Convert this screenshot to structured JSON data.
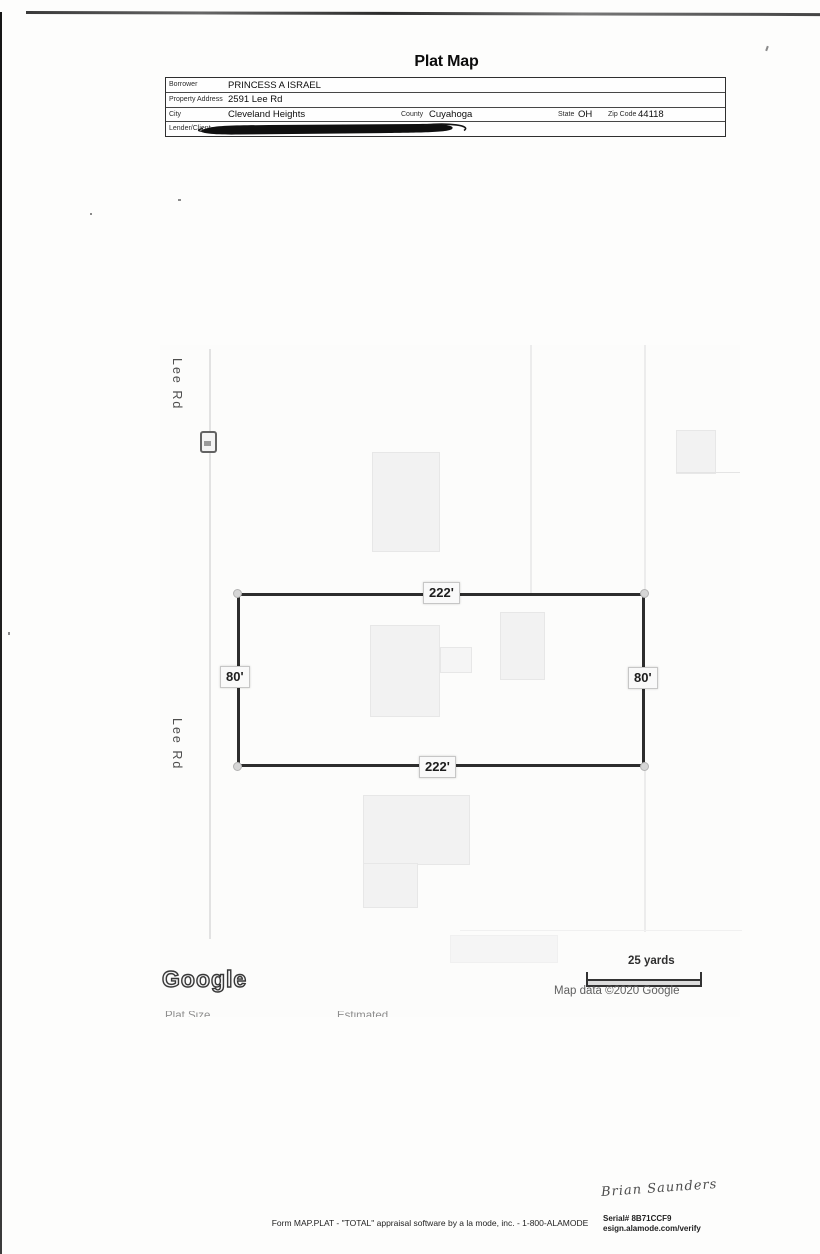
{
  "page": {
    "title": "Plat Map"
  },
  "form": {
    "rows": [
      {
        "label": "Borrower",
        "value": "PRINCESS A ISRAEL"
      },
      {
        "label": "Property Address",
        "value": "2591 Lee Rd"
      },
      {
        "label": "City",
        "value": "Cleveland Heights",
        "county_label": "County",
        "county_value": "Cuyahoga",
        "state_label": "State",
        "state_value": "OH",
        "zip_label": "Zip Code",
        "zip_value": "44118"
      },
      {
        "label": "Lender/Client",
        "value": ""
      }
    ]
  },
  "map": {
    "road_label": "Lee Rd",
    "plat_dimensions": {
      "top": "222'",
      "bottom": "222'",
      "left": "80'",
      "right": "80'"
    },
    "scale_label": "25 yards",
    "attribution": "Map data ©2020 Google",
    "logo_text": "Google",
    "clipped_caption": {
      "left": "Plat Size",
      "right": "Estimated"
    }
  },
  "footer": {
    "form_line": "Form MAP.PLAT - \"TOTAL\" appraisal software by a la mode, inc. - 1-800-ALAMODE",
    "serial": "Serial# 8B71CCF9",
    "esign": "esign.alamode.com/verify",
    "signature": "Brian Saunders"
  }
}
